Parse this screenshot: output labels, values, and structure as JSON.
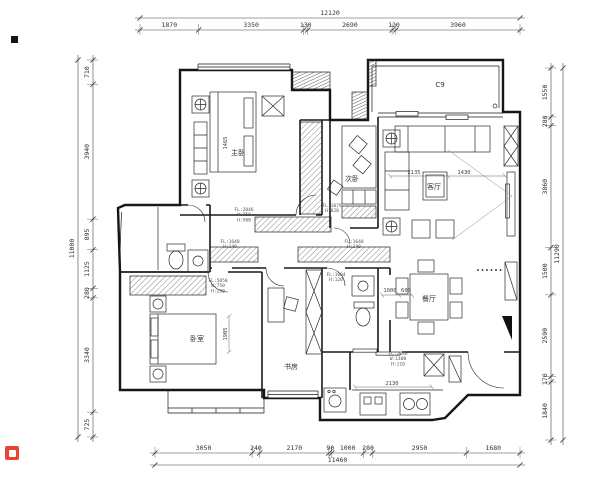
{
  "drawing": {
    "title": "apartment-floor-plan",
    "units": "mm",
    "dimensions": {
      "top": {
        "overall": "12120",
        "segments": [
          "1870",
          "3350",
          "130",
          "2690",
          "120",
          "3960"
        ]
      },
      "bottom": {
        "overall": "11460",
        "segments": [
          "3050",
          "240",
          "2170",
          "90",
          "1000",
          "280",
          "2950",
          "1680"
        ]
      },
      "left": {
        "overall": "11000",
        "segments": [
          "710",
          "3940",
          "895",
          "1125",
          "280",
          "3340",
          "725"
        ]
      },
      "right": {
        "overall": "11290",
        "segments": [
          "1550",
          "280",
          "3860",
          "1500",
          "2590",
          "170",
          "1840"
        ]
      }
    },
    "room_labels": [
      {
        "text": "主卧",
        "x": 238,
        "y": 155
      },
      {
        "text": "次卧",
        "x": 352,
        "y": 181
      },
      {
        "text": "客厅",
        "x": 434,
        "y": 189
      },
      {
        "text": "餐厅",
        "x": 429,
        "y": 301
      },
      {
        "text": "书房",
        "x": 291,
        "y": 369
      },
      {
        "text": "卧室",
        "x": 197,
        "y": 341
      },
      {
        "text": "C9",
        "x": 440,
        "y": 87
      }
    ],
    "annotations": [
      {
        "x": 244,
        "y": 211,
        "lines": [
          "FL:2046",
          "W:750",
          "H:500"
        ]
      },
      {
        "x": 332,
        "y": 207,
        "lines": [
          "FL:1879",
          "H:820"
        ]
      },
      {
        "x": 230,
        "y": 243,
        "lines": [
          "FL:1640",
          "H:140"
        ]
      },
      {
        "x": 354,
        "y": 243,
        "lines": [
          "FL:1640",
          "H:140"
        ]
      },
      {
        "x": 218,
        "y": 282,
        "lines": [
          "FL:5050",
          "W:750",
          "H:250"
        ]
      },
      {
        "x": 336,
        "y": 276,
        "lines": [
          "FL:1004",
          "H:120"
        ]
      },
      {
        "x": 398,
        "y": 355,
        "lines": [
          "FL:2046",
          "W:1400",
          "H:110"
        ]
      }
    ],
    "interior_dims": [
      {
        "text": "2135",
        "x": 414,
        "y": 174,
        "rot": 0
      },
      {
        "text": "1430",
        "x": 464,
        "y": 174,
        "rot": 0
      },
      {
        "text": "1000",
        "x": 390,
        "y": 292,
        "rot": 0
      },
      {
        "text": "600",
        "x": 406,
        "y": 292,
        "rot": 0
      },
      {
        "text": "1905",
        "x": 227,
        "y": 334,
        "rot": -90
      },
      {
        "text": "1465",
        "x": 227,
        "y": 143,
        "rot": -90
      },
      {
        "text": "2130",
        "x": 392,
        "y": 385,
        "rot": 0
      }
    ],
    "colors": {
      "line": "#1a1a1a",
      "dim": "#555555",
      "brand": "#e8442e"
    }
  }
}
